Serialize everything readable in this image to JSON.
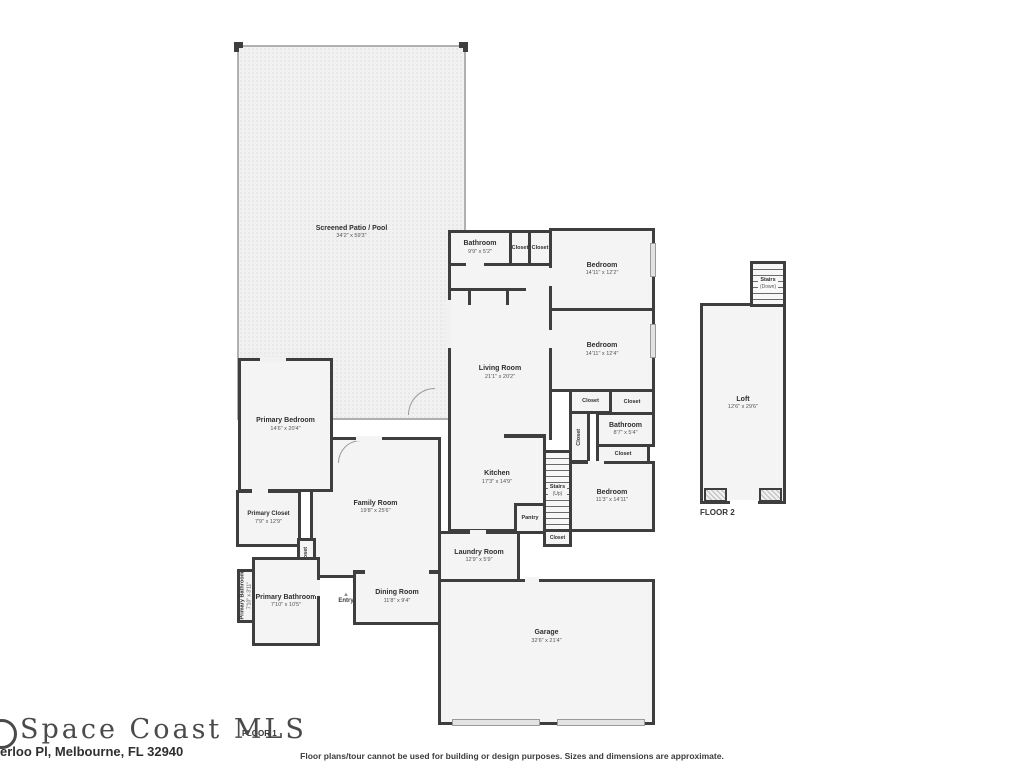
{
  "page": {
    "logo": "Space Coast MLS",
    "address": "erloo Pl, Melbourne, FL 32940",
    "floor1_label": "FLOOR 1",
    "floor2_label": "FLOOR 2",
    "disclaimer": "Floor plans/tour cannot be used for building or design purposes. Sizes and dimensions are approximate."
  },
  "colors": {
    "wall": "#3e3e3e",
    "room_fill": "#f4f4f4",
    "patio_fill": "#f1f1f1",
    "text": "#3a3a3a"
  },
  "rooms": {
    "patio": {
      "name": "Screened Patio / Pool",
      "dims": "34'2\" x 59'3\""
    },
    "bathroom_guest": {
      "name": "Bathroom",
      "dims": "9'9\" x 5'2\""
    },
    "bedroom_top": {
      "name": "Bedroom",
      "dims": "14'11\" x 12'2\""
    },
    "bedroom_mid": {
      "name": "Bedroom",
      "dims": "14'11\" x 12'4\""
    },
    "living": {
      "name": "Living Room",
      "dims": "21'1\" x 20'2\""
    },
    "bathroom_hall": {
      "name": "Bathroom",
      "dims": "8'7\" x 5'4\""
    },
    "bedroom_back": {
      "name": "Bedroom",
      "dims": "11'3\" x 14'11\""
    },
    "stairs_up": {
      "name": "Stairs",
      "dims": "(Up)"
    },
    "kitchen": {
      "name": "Kitchen",
      "dims": "17'3\" x 14'9\""
    },
    "pantry": {
      "name": "Pantry"
    },
    "family": {
      "name": "Family Room",
      "dims": "19'8\" x 25'6\""
    },
    "primary_bedroom": {
      "name": "Primary Bedroom",
      "dims": "14'6\" x 20'4\""
    },
    "primary_closet": {
      "name": "Primary Closet",
      "dims": "7'9\" x 12'9\""
    },
    "primary_bathroom": {
      "name": "Primary Bathroom",
      "dims": "7'10\" x 10'5\""
    },
    "primary_wc": {
      "name": "Primary Bathroom",
      "dims": "7'10\" x 3'11\""
    },
    "dining": {
      "name": "Dining Room",
      "dims": "11'8\" x 9'4\""
    },
    "entry": {
      "name": "Entry"
    },
    "laundry": {
      "name": "Laundry Room",
      "dims": "12'9\" x 5'9\""
    },
    "garage": {
      "name": "Garage",
      "dims": "32'6\" x 21'4\""
    },
    "stairs_down": {
      "name": "Stairs",
      "dims": "(Down)"
    },
    "loft": {
      "name": "Loft",
      "dims": "12'6\" x 29'6\""
    },
    "closet": {
      "name": "Closet"
    }
  }
}
